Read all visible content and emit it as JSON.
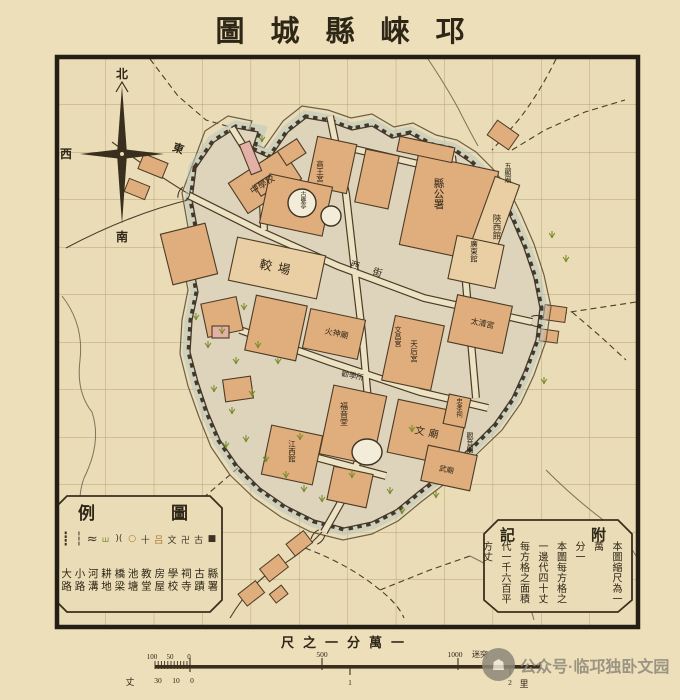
{
  "colors": {
    "paper": "#ecdfba",
    "paper-in": "#eadcb6",
    "ink": "#3a2f1f",
    "grid": "#b5a077",
    "city": "#ded4bc",
    "halo": "#b7c8c2",
    "building": "#e0ad7d",
    "building-light": "#e9cfa3",
    "pink": "#e3b0a6",
    "pond": "#f2ecd8",
    "grass": "#7b8d2e",
    "street": "#ece2c4",
    "water": "#6b5f49",
    "label": "#2f2718",
    "watermark": "#8e887a"
  },
  "title": {
    "display": "圖城縣崍邛",
    "reading": "邛崍縣城圖"
  },
  "compass": {
    "north": "北",
    "west": "西",
    "east": "東",
    "south": "南"
  },
  "map": {
    "labels": [
      {
        "text": "縣公署"
      },
      {
        "text": "陝西館"
      },
      {
        "text": "五顯廟"
      },
      {
        "text": "中學校"
      },
      {
        "text": "高王宮"
      },
      {
        "text": "古甕亭"
      },
      {
        "text": "較場"
      },
      {
        "text": "西街"
      },
      {
        "text": "火神廟"
      },
      {
        "text": "天后宮"
      },
      {
        "text": "文昌宮"
      },
      {
        "text": "勸學所"
      },
      {
        "text": "文廟"
      },
      {
        "text": "武廟"
      },
      {
        "text": "觀音閣"
      },
      {
        "text": "江西館"
      },
      {
        "text": "福音堂"
      },
      {
        "text": "太清宮"
      },
      {
        "text": "廣東館"
      },
      {
        "text": "忠孝祠"
      }
    ]
  },
  "legend": {
    "title_display": "例圖",
    "items": [
      {
        "symbol": "┋",
        "label": "大路"
      },
      {
        "symbol": "┆",
        "label": "小路"
      },
      {
        "symbol": "≈",
        "label": "河溝"
      },
      {
        "symbol": "ш",
        "label": "耕地"
      },
      {
        "symbol": ")(",
        "label": "橋梁"
      },
      {
        "symbol": "○",
        "label": "池塘"
      },
      {
        "symbol": "十",
        "label": "教堂"
      },
      {
        "symbol": "吕",
        "label": "房屋"
      },
      {
        "symbol": "文",
        "label": "學校"
      },
      {
        "symbol": "卍",
        "label": "祠寺"
      },
      {
        "symbol": "古",
        "label": "古蹟"
      },
      {
        "symbol": "■",
        "label": "縣署"
      }
    ]
  },
  "notes": {
    "title_display": "記附",
    "text": "本圖縮尺為一萬\n分一\n本圖每方格之\n一邊代四十丈\n每方格之面積\n代一千六百平\n方丈"
  },
  "scale_bar": {
    "title": "尺之一分萬一",
    "m100": "100",
    "m50": "50",
    "m0": "0",
    "m500": "500",
    "m1000": "1000",
    "unit_m": "迷突",
    "z": "丈",
    "z30": "30",
    "z10": "10",
    "z0": "0",
    "li1": "1",
    "li2": "2",
    "unit_li": "里"
  },
  "watermark": {
    "text": "公众号·临邛独卧文园"
  }
}
